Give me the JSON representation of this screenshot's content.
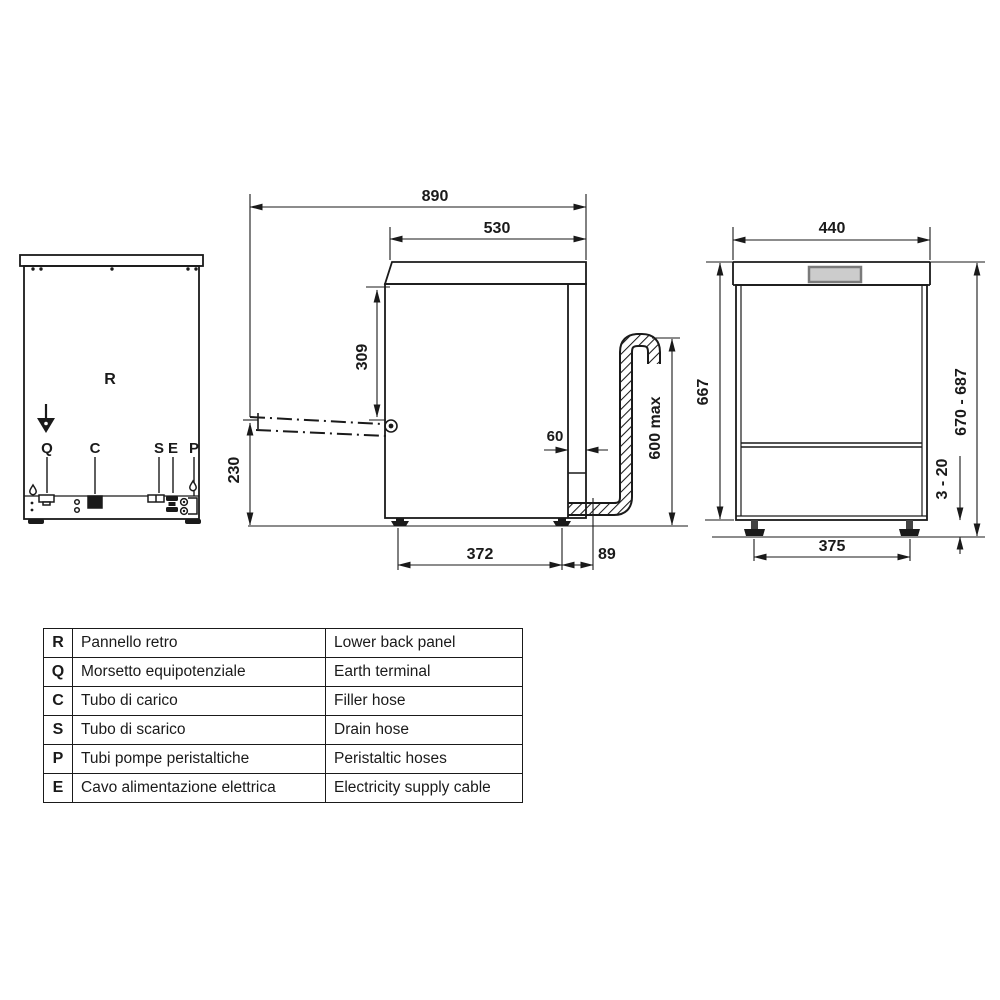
{
  "rear_view": {
    "panel": "R",
    "q": "Q",
    "c": "C",
    "s": "S",
    "e": "E",
    "p": "P"
  },
  "side_view": {
    "depth_door_open": "890",
    "depth": "530",
    "top_to_hinge": "309",
    "door_open_height": "230",
    "rear_gap": "60",
    "drain_max_height": "600 max",
    "feet_depth_spacing": "372",
    "rear_overhang": "89"
  },
  "front_view": {
    "width": "440",
    "body_height": "667",
    "overall_height": "670 - 687",
    "feet_adjust_range": "3 - 20",
    "feet_width_spacing": "375"
  },
  "legend": {
    "rows": [
      {
        "code": "R",
        "it": "Pannello retro",
        "en": "Lower back panel"
      },
      {
        "code": "Q",
        "it": "Morsetto equipotenziale",
        "en": "Earth terminal"
      },
      {
        "code": "C",
        "it": "Tubo di carico",
        "en": "Filler hose"
      },
      {
        "code": "S",
        "it": "Tubo di scarico",
        "en": "Drain hose"
      },
      {
        "code": "P",
        "it": "Tubi pompe peristaltiche",
        "en": "Peristaltic hoses"
      },
      {
        "code": "E",
        "it": "Cavo alimentazione elettrica",
        "en": "Electricity supply cable"
      }
    ]
  },
  "colors": {
    "line": "#1a1a1a",
    "display_fill": "#cccccc",
    "display_border": "#7a7a7a",
    "background": "#ffffff"
  }
}
